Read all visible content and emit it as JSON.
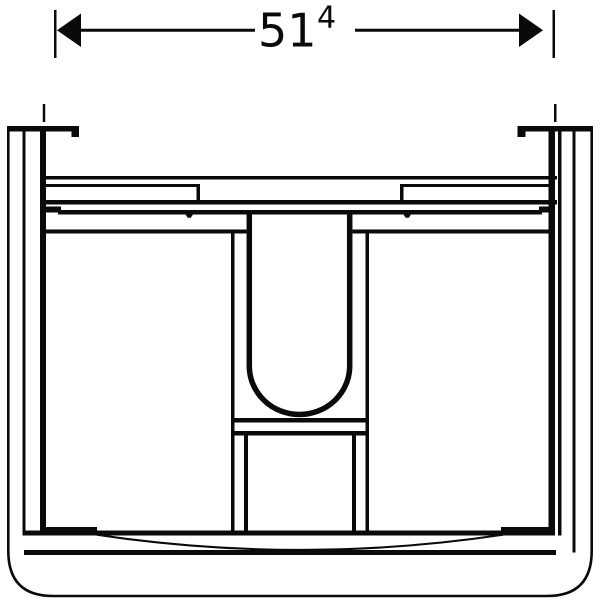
{
  "drawing": {
    "type": "technical-front-view",
    "subject": "bathroom vanity cabinet front elevation",
    "colors": {
      "line": "#0a0a0a",
      "background": "#ffffff"
    },
    "dimension": {
      "value_main": "51",
      "value_superscript": "4"
    }
  }
}
